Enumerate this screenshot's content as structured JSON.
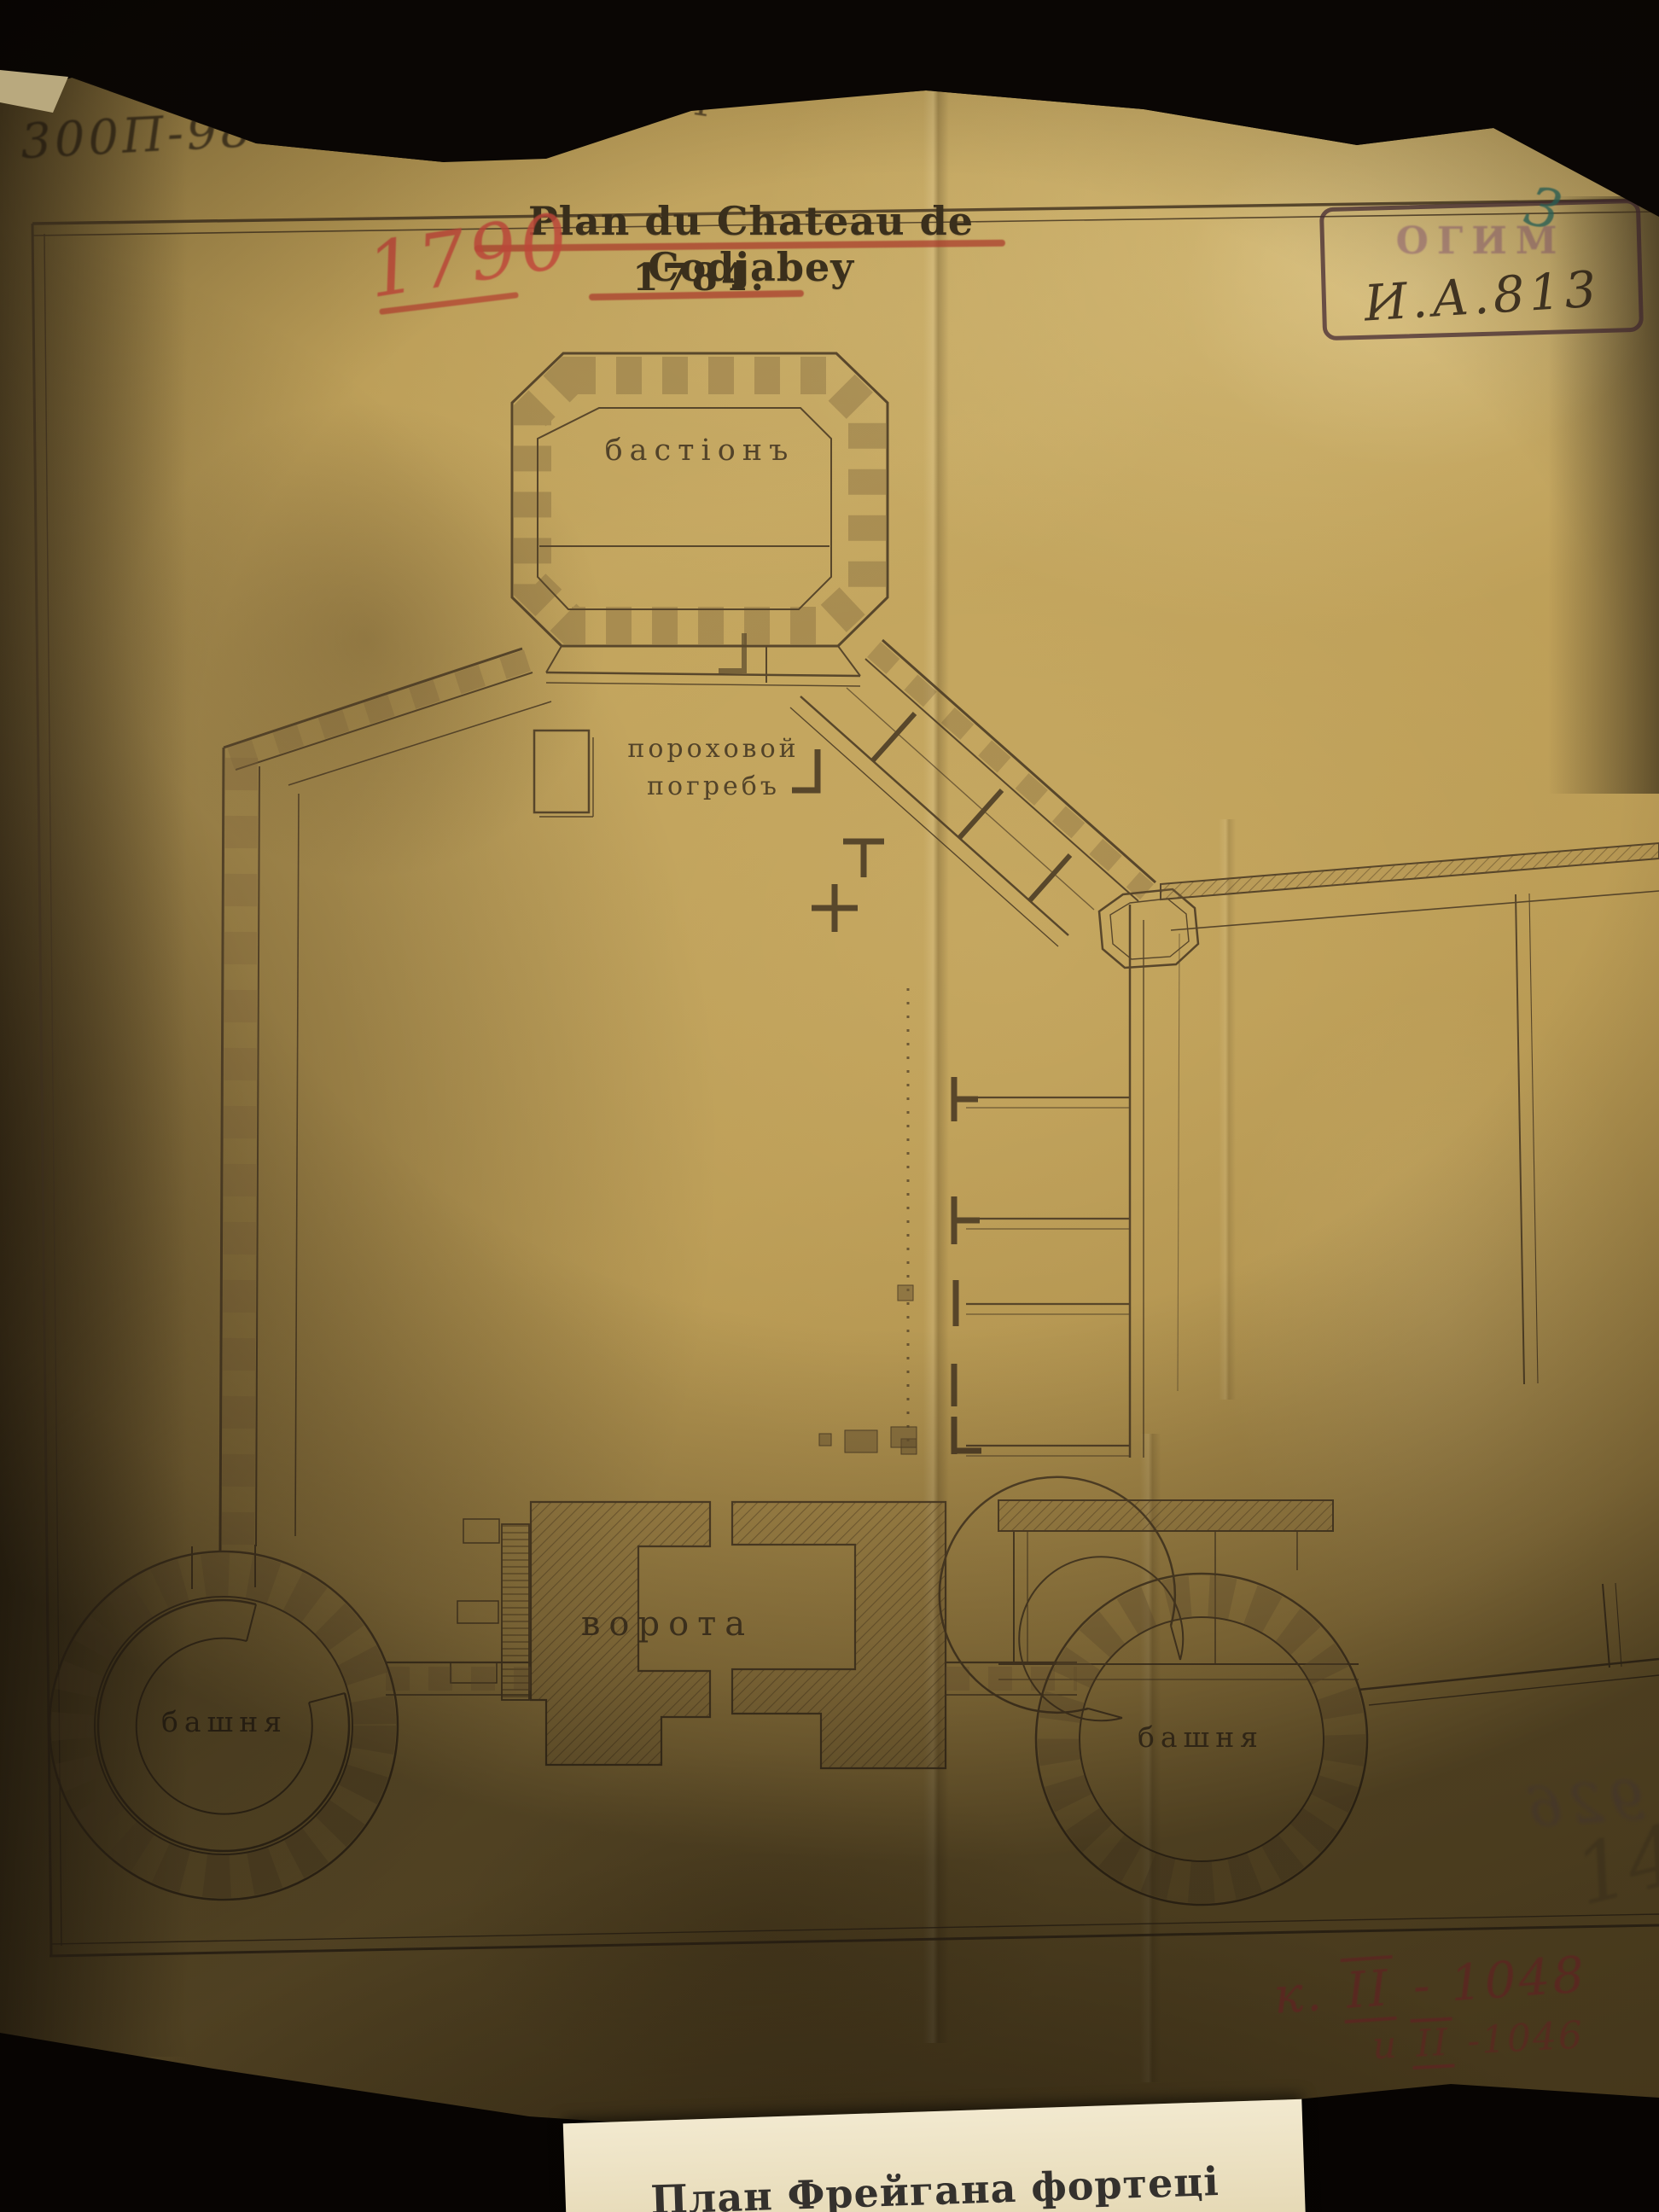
{
  "document": {
    "title": "Plan du Chateau de Codjabey",
    "year_printed": "1784.",
    "year_corrected_red": "1790",
    "labels": {
      "bastion": "бастіонъ",
      "powder_magazine_line1": "пороховой",
      "powder_magazine_line2": "погребъ",
      "gate": "ворота",
      "tower_left": "башня",
      "tower_right": "башня"
    }
  },
  "archival_marks": {
    "top_left_inventory": "300П-98 VI",
    "top_center_pencil": "4",
    "stamp_museum": "ОГИМ",
    "stamp_inventory": "И.А.813",
    "blue_number": "3",
    "red_note_1_prefix": "к.",
    "red_note_1_roman": "II",
    "red_note_1_rest": "- 1048",
    "red_note_2_prefix": "и",
    "red_note_2_roman": "II",
    "red_note_2_rest": "-1046",
    "mirrored_ink_bleed": "926",
    "pencil_bottom_right": "14"
  },
  "caption_card": {
    "text": "План Фрейгана фортеці Гаджибей 1789 р."
  },
  "colors": {
    "paper_light": "#c9ab63",
    "paper_dark": "#7a6231",
    "ink_drawing": "#4a3a24",
    "ink_red": "#b8453a",
    "stamp_purple": "#8a5574",
    "blue_ink": "#2e6e62",
    "background_black": "#0a0604",
    "card_white": "#efe5c6"
  }
}
